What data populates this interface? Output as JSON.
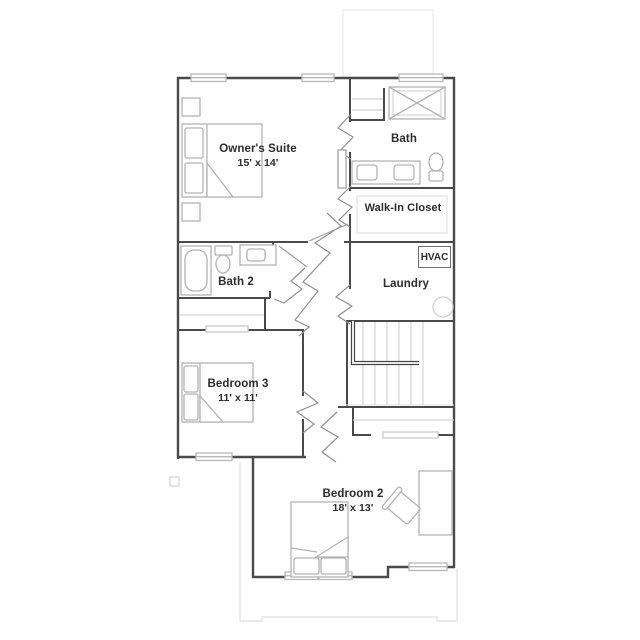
{
  "plan": {
    "type": "second-floor residential floor plan",
    "labels": {
      "owners_suite": {
        "name": "Owner's Suite",
        "dims": "15' x 14'"
      },
      "bath": {
        "name": "Bath"
      },
      "walk_in_closet": {
        "name": "Walk-In Closet"
      },
      "hvac": {
        "name": "HVAC"
      },
      "laundry": {
        "name": "Laundry"
      },
      "bath_2": {
        "name": "Bath 2"
      },
      "bedroom_3": {
        "name": "Bedroom 3",
        "dims": "11' x 11'"
      },
      "bedroom_2": {
        "name": "Bedroom 2",
        "dims": "18' x 13'"
      }
    },
    "colors": {
      "wall": "#4a4a4a",
      "furniture": "#b3b3b3",
      "faint_outline": "#e9e9e9",
      "label_text": "#2d2d2d",
      "background": "#ffffff"
    }
  }
}
